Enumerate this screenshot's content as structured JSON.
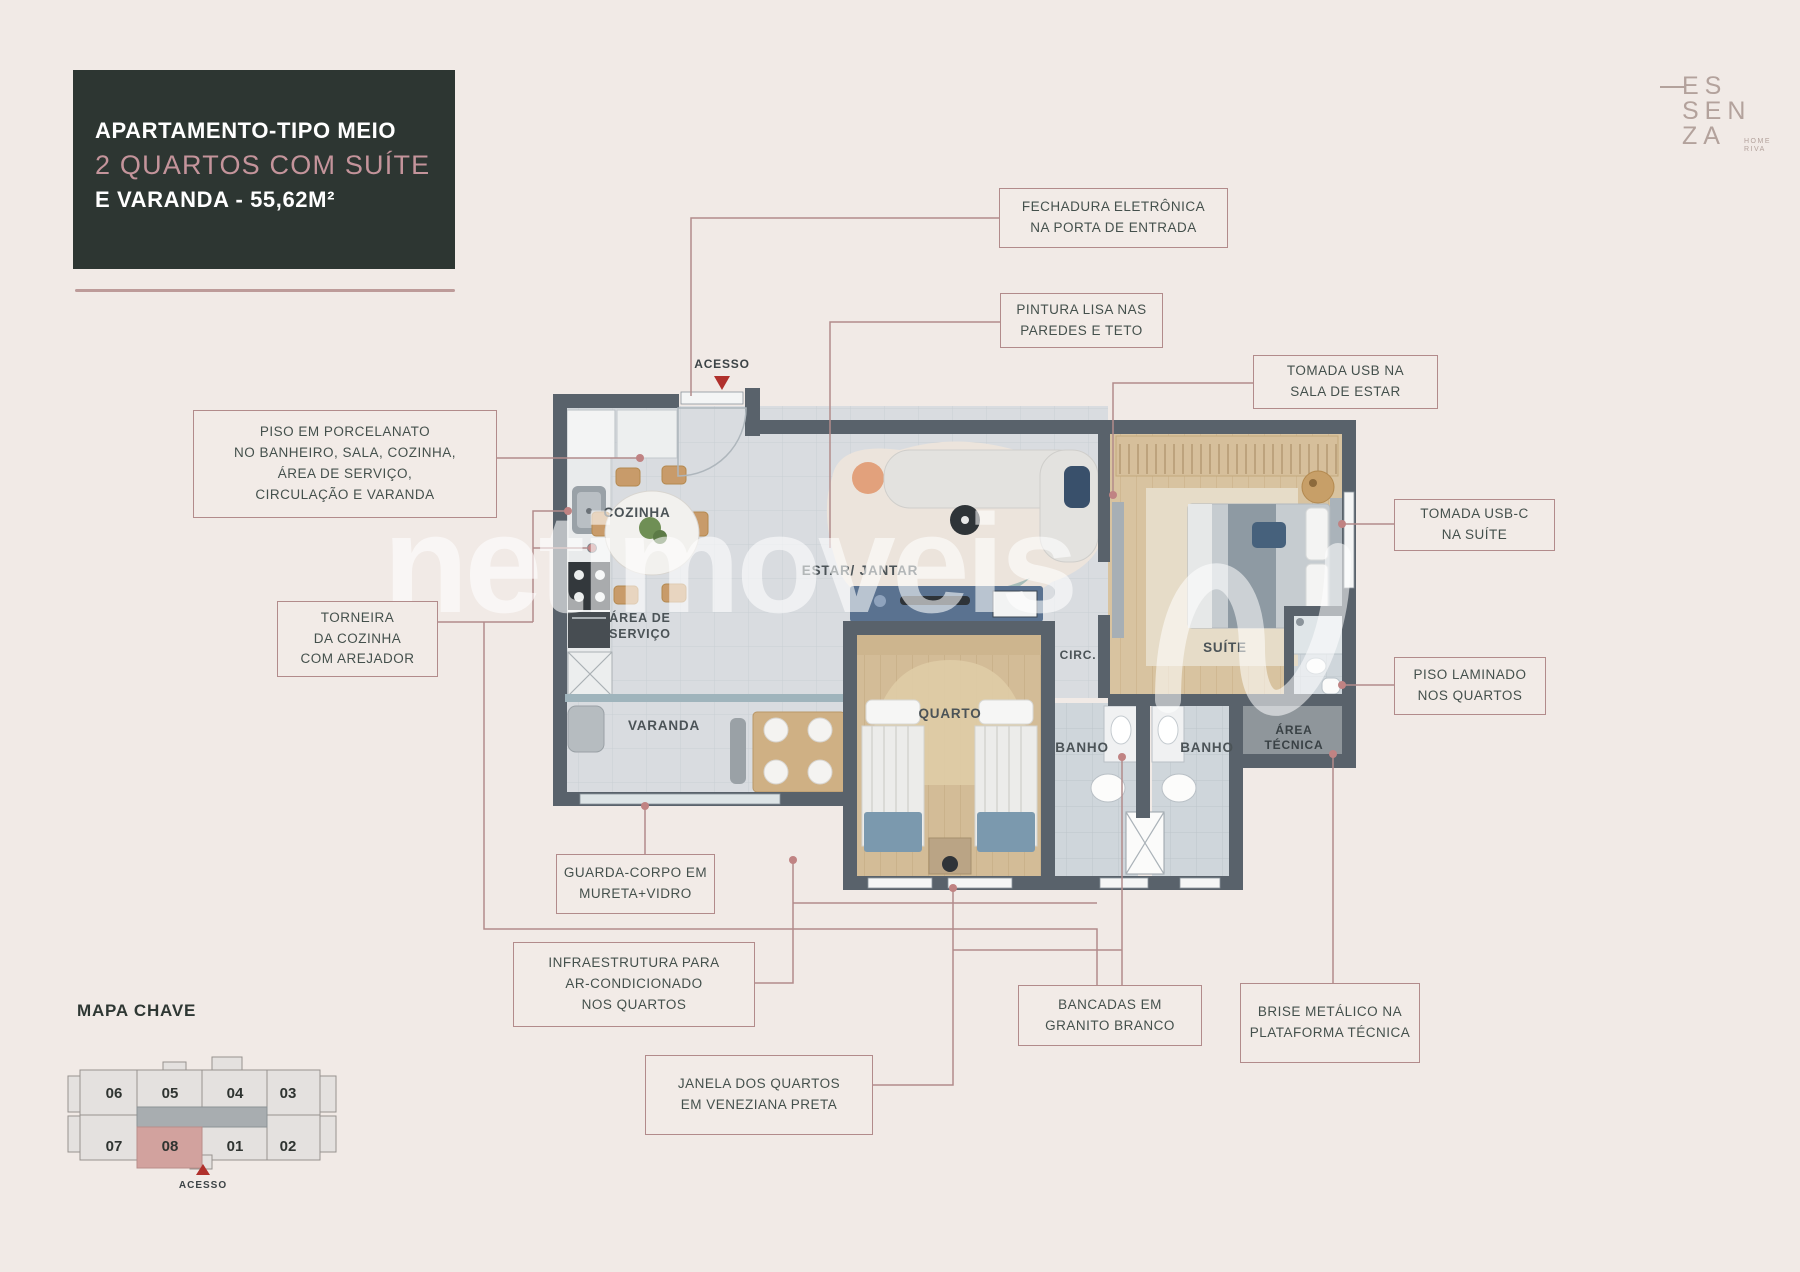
{
  "colors": {
    "background": "#f1eae6",
    "accent_rose": "#b28b8b",
    "title_card_bg": "#2d3632",
    "title_rose_text": "#c4949b",
    "wall": "#59626b",
    "highlight_unit": "#d2a29e",
    "acesso_red": "#b0302c",
    "logo_taupe": "#b3a29c"
  },
  "title_card": {
    "line1": "APARTAMENTO-TIPO MEIO",
    "line2": "2 QUARTOS COM SUÍTE",
    "line3": "E VARANDA - 55,62M²"
  },
  "logo": {
    "line1": "ES",
    "line2": "SEN",
    "line3": "ZA",
    "sub1": "HOME",
    "sub2": "RIVA"
  },
  "watermark": {
    "text": "netimoveis"
  },
  "callouts": {
    "fechadura": {
      "lines": [
        "FECHADURA ELETRÔNICA",
        "NA PORTA DE ENTRADA"
      ]
    },
    "pintura": {
      "lines": [
        "PINTURA LISA NAS",
        "PAREDES E TETO"
      ]
    },
    "tomada_usb": {
      "lines": [
        "TOMADA USB NA",
        "SALA DE ESTAR"
      ]
    },
    "tomada_usbc": {
      "lines": [
        "TOMADA USB-C",
        "NA SUÍTE"
      ]
    },
    "piso_porcelanato": {
      "lines": [
        "PISO EM PORCELANATO",
        "NO BANHEIRO, SALA, COZINHA,",
        "ÁREA DE SERVIÇO,",
        "CIRCULAÇÃO E VARANDA"
      ]
    },
    "torneira": {
      "lines": [
        "TORNEIRA",
        "DA COZINHA",
        "COM AREJADOR"
      ]
    },
    "piso_laminado": {
      "lines": [
        "PISO LAMINADO",
        "NOS QUARTOS"
      ]
    },
    "guarda_corpo": {
      "lines": [
        "GUARDA-CORPO EM",
        "MURETA+VIDRO"
      ]
    },
    "infraestrutura": {
      "lines": [
        "INFRAESTRUTURA PARA",
        "AR-CONDICIONADO",
        "NOS QUARTOS"
      ]
    },
    "janela": {
      "lines": [
        "JANELA DOS QUARTOS",
        "EM VENEZIANA PRETA"
      ]
    },
    "bancadas": {
      "lines": [
        "BANCADAS EM",
        "GRANITO BRANCO"
      ]
    },
    "brise": {
      "lines": [
        "BRISE METÁLICO NA",
        "PLATAFORMA TÉCNICA"
      ]
    }
  },
  "plan": {
    "labels": {
      "acesso": "ACESSO",
      "cozinha": "COZINHA",
      "estar": "ESTAR/ JANTAR",
      "area_servico_1": "ÁREA DE",
      "area_servico_2": "SERVIÇO",
      "varanda": "VARANDA",
      "quarto": "QUARTO",
      "circ": "CIRC.",
      "suite": "SUÍTE",
      "banho_1": "BANHO",
      "banho_2": "BANHO",
      "area_tecnica_1": "ÁREA",
      "area_tecnica_2": "TÉCNICA"
    }
  },
  "mapa_chave": {
    "title": "MAPA CHAVE",
    "units_top": [
      "06",
      "05",
      "04",
      "03"
    ],
    "units_bottom": [
      "07",
      "08",
      "01",
      "02"
    ],
    "highlighted_unit": "08",
    "acesso": "ACESSO"
  }
}
